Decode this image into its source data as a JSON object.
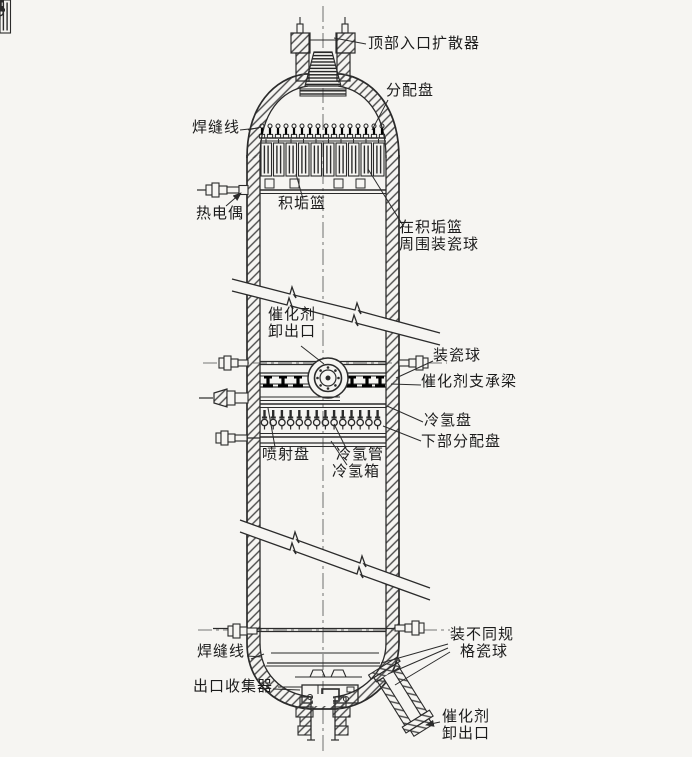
{
  "figure": {
    "background_color": "#f6f5f2",
    "ink_color": "#2b2b2b",
    "subject": "fixed-bed catalytic reactor cutaway diagram"
  },
  "labels": {
    "top_inlet_diffuser": {
      "lines": [
        "顶部入口扩散器"
      ]
    },
    "distribution_tray": {
      "lines": [
        "分配盘"
      ]
    },
    "weld_line_top": {
      "lines": [
        "焊缝线"
      ]
    },
    "thermocouple": {
      "lines": [
        "热电偶"
      ]
    },
    "scale_basket": {
      "lines": [
        "积垢篮"
      ]
    },
    "balls_around_basket": {
      "lines": [
        "在积垢篮",
        "周围装瓷球"
      ]
    },
    "catalyst_unload_mid": {
      "lines": [
        "催化剂",
        "卸出口"
      ]
    },
    "porcelain_balls": {
      "lines": [
        "装瓷球"
      ]
    },
    "catalyst_support_beam": {
      "lines": [
        "催化剂支承梁"
      ]
    },
    "cold_hydrogen_tray": {
      "lines": [
        "冷氢盘"
      ]
    },
    "lower_distribution_tray": {
      "lines": [
        "下部分配盘"
      ]
    },
    "spray_tray": {
      "lines": [
        "喷射盘"
      ]
    },
    "cold_hydrogen_pipe": {
      "lines": [
        "冷氢管"
      ]
    },
    "cold_hydrogen_box": {
      "lines": [
        "冷氢箱"
      ]
    },
    "weld_line_bottom": {
      "lines": [
        "焊缝线"
      ]
    },
    "outlet_collector": {
      "lines": [
        "出口收集器"
      ]
    },
    "different_spec_balls": {
      "lines": [
        "装不同规",
        "格瓷球"
      ]
    },
    "catalyst_unload_bottom": {
      "lines": [
        "催化剂",
        "卸出口"
      ]
    }
  }
}
